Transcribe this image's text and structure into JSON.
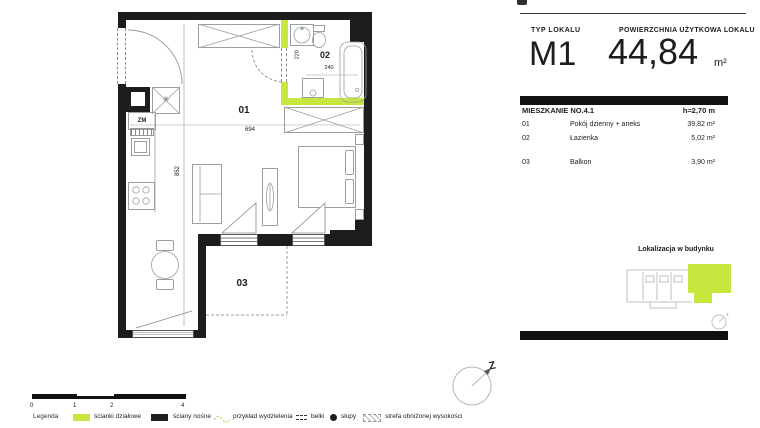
{
  "colors": {
    "accent": "#c5e73e",
    "wall": "#1d1d1d"
  },
  "header": {
    "typ_label": "TYP LOKALU",
    "typ_value": "M1",
    "area_label": "POWIERZCHNIA UŻYTKOWA LOKALU",
    "area_value": "44,84",
    "area_unit": "m²"
  },
  "unit": {
    "title": "MIESZKANIE NO.4.1",
    "ceiling": "h=2,70 m",
    "rooms": [
      {
        "no": "01",
        "name": "Pokój dzienny + aneks",
        "area": "39,82 m²"
      },
      {
        "no": "02",
        "name": "Łazienka",
        "area": "5,02 m²"
      },
      {
        "no": "03",
        "name": "Balkon",
        "area": "3,90 m²"
      }
    ]
  },
  "location": {
    "title": "Lokalizacja w budynku",
    "compass_letter": "z"
  },
  "plan": {
    "labels": {
      "room1": "01",
      "room2": "02",
      "room3": "03"
    },
    "dims": {
      "width": "694",
      "height": "852",
      "bath_h": "220",
      "bath_w": "240"
    },
    "appliances": {
      "dishwasher": "ZM",
      "fridge_symbol": "✳"
    },
    "compass_letter": "Z"
  },
  "legend": {
    "title": "Legenda",
    "scale_ticks": [
      "0",
      "1",
      "2",
      "4"
    ],
    "items": [
      {
        "label": "ścianki działowe"
      },
      {
        "label": "ściany nośne"
      },
      {
        "label": "przykład wydzielenia"
      },
      {
        "label": "belki"
      },
      {
        "label": "słupy"
      },
      {
        "label": "strefa obniżonej wysokości"
      }
    ]
  }
}
